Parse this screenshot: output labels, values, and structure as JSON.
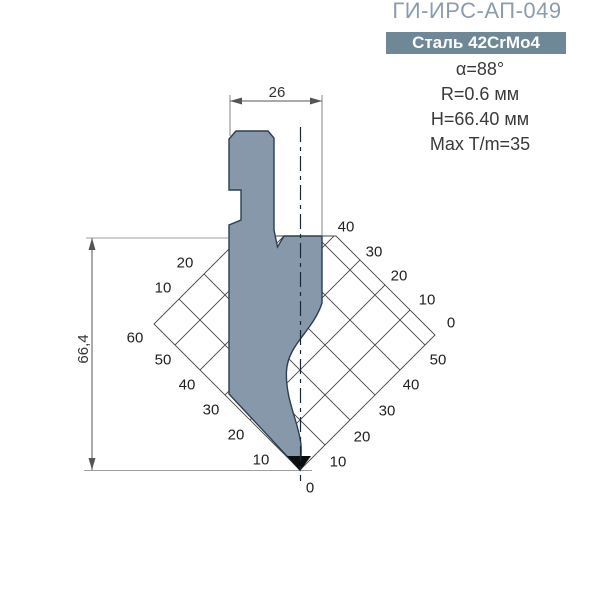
{
  "header": {
    "title": "ГИ-ИРС-АП-049",
    "material_badge": "Сталь 42CrMo4",
    "specs": {
      "angle": "α=88°",
      "radius": "R=0.6 мм",
      "height": "H=66.40 мм",
      "max_load": "Max T/m=35"
    }
  },
  "drawing": {
    "top_width_dim": "26",
    "left_height_dim": "66,4",
    "scale_labels": [
      {
        "t": "20",
        "x": 185,
        "y": 262
      },
      {
        "t": "10",
        "x": 163,
        "y": 287
      },
      {
        "t": "60",
        "x": 135,
        "y": 337
      },
      {
        "t": "50",
        "x": 163,
        "y": 359
      },
      {
        "t": "40",
        "x": 187,
        "y": 384
      },
      {
        "t": "30",
        "x": 211,
        "y": 409
      },
      {
        "t": "20",
        "x": 236,
        "y": 434
      },
      {
        "t": "10",
        "x": 261,
        "y": 459
      },
      {
        "t": "0",
        "x": 310,
        "y": 487
      },
      {
        "t": "10",
        "x": 338,
        "y": 461
      },
      {
        "t": "20",
        "x": 362,
        "y": 436
      },
      {
        "t": "30",
        "x": 387,
        "y": 410
      },
      {
        "t": "40",
        "x": 411,
        "y": 384
      },
      {
        "t": "50",
        "x": 438,
        "y": 359
      },
      {
        "t": "0",
        "x": 451,
        "y": 322
      },
      {
        "t": "10",
        "x": 427,
        "y": 299
      },
      {
        "t": "20",
        "x": 399,
        "y": 275
      },
      {
        "t": "30",
        "x": 374,
        "y": 251
      },
      {
        "t": "40",
        "x": 346,
        "y": 226
      }
    ],
    "colors": {
      "title_text": "#8C9CAE",
      "badge_bg": "#6E8898",
      "badge_text": "#FFFFFF",
      "punch_fill": "#8798AA",
      "punch_outline": "#2C3E50",
      "tip": "#0D0D0D",
      "grid_line": "#444444",
      "dim_line": "#555555",
      "spec_text": "#3A3A3A"
    }
  }
}
